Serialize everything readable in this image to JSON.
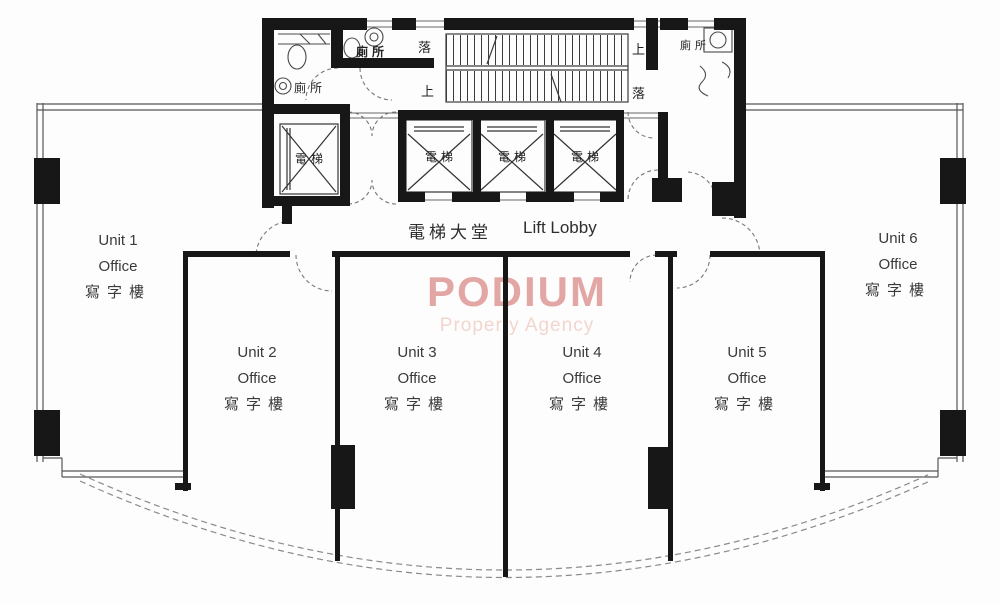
{
  "watermark": {
    "title": "PODIUM",
    "subtitle": "Property Agency"
  },
  "lobby": {
    "label_zh": "電梯大堂",
    "label_en": "Lift Lobby"
  },
  "labels": {
    "lift": "電梯",
    "toilet": "廁所",
    "up": "上",
    "down": "落"
  },
  "units": [
    {
      "name": "Unit 1",
      "type": "Office",
      "name_zh": "寫字樓"
    },
    {
      "name": "Unit 2",
      "type": "Office",
      "name_zh": "寫字樓"
    },
    {
      "name": "Unit 3",
      "type": "Office",
      "name_zh": "寫字樓"
    },
    {
      "name": "Unit 4",
      "type": "Office",
      "name_zh": "寫字樓"
    },
    {
      "name": "Unit 5",
      "type": "Office",
      "name_zh": "寫字樓"
    },
    {
      "name": "Unit 6",
      "type": "Office",
      "name_zh": "寫字樓"
    }
  ],
  "colors": {
    "wall": "#171717",
    "thin_line": "#555555",
    "watermark_title": "#e2a7a4",
    "watermark_subtitle": "#f2d6ce"
  }
}
